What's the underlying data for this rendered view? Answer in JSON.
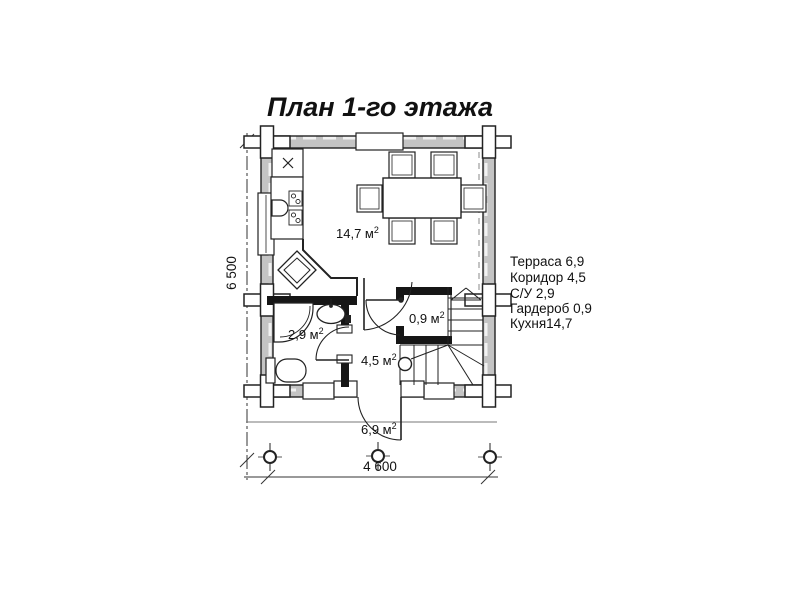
{
  "title": "План 1-го этажа",
  "legend": {
    "items": [
      "Терраса 6,9",
      "Коридор 4,5",
      "С/У 2,9",
      "Гардероб 0,9",
      "Кухня14,7"
    ]
  },
  "rooms": {
    "kitchen": {
      "area": "14,7 м",
      "sup": "2"
    },
    "bathroom": {
      "area": "2,9 м",
      "sup": "2"
    },
    "wardrobe": {
      "area": "0,9 м",
      "sup": "2"
    },
    "corridor": {
      "area": "4,5 м",
      "sup": "2"
    },
    "terrace": {
      "area": "6,9 м",
      "sup": "2"
    }
  },
  "dimensions": {
    "width": "4 600",
    "height": "6 500"
  },
  "colors": {
    "wall_fill": "#c4c4c4",
    "line": "#1a1a1a",
    "background": "#ffffff"
  }
}
